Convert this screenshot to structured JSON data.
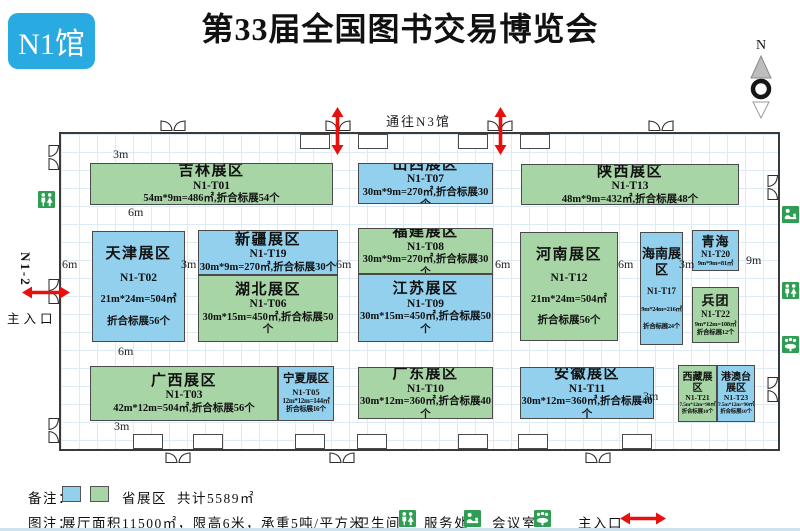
{
  "header": {
    "hall_badge": "N1馆",
    "title": "第33届全国图书交易博览会",
    "compass_north": "N"
  },
  "plan": {
    "corridor_label": "通往N3馆",
    "left_entrance_code": "N1-2",
    "left_entrance_label": "主入口",
    "dims": [
      "3m",
      "6m",
      "6m",
      "3m",
      "6m",
      "6m",
      "6m",
      "3m",
      "9m",
      "6m",
      "3m",
      "3m"
    ],
    "zones": [
      {
        "id": "jilin",
        "name": "吉林展区",
        "code": "N1-T01",
        "line3": "54m*9m=486㎡,折合标展54个",
        "line4": "",
        "color": "green"
      },
      {
        "id": "shanxi",
        "name": "山西展区",
        "code": "N1-T07",
        "line3": "30m*9m=270㎡,折合标展30个",
        "line4": "",
        "color": "blue"
      },
      {
        "id": "shaanxi",
        "name": "陕西展区",
        "code": "N1-T13",
        "line3": "48m*9m=432㎡,折合标展48个",
        "line4": "",
        "color": "green"
      },
      {
        "id": "tianjin",
        "name": "天津展区",
        "code": "N1-T02",
        "line3": "21m*24m=504㎡",
        "line4": "折合标展56个",
        "color": "blue"
      },
      {
        "id": "xinjiang",
        "name": "新疆展区",
        "code": "N1-T19",
        "line3": "30m*9m=270㎡,折合标展30个",
        "line4": "",
        "color": "blue"
      },
      {
        "id": "hubei",
        "name": "湖北展区",
        "code": "N1-T06",
        "line3": "30m*15m=450㎡,折合标展50个",
        "line4": "",
        "color": "green"
      },
      {
        "id": "fujian",
        "name": "福建展区",
        "code": "N1-T08",
        "line3": "30m*9m=270㎡,折合标展30个",
        "line4": "",
        "color": "green"
      },
      {
        "id": "jiangsu",
        "name": "江苏展区",
        "code": "N1-T09",
        "line3": "30m*15m=450㎡,折合标展50个",
        "line4": "",
        "color": "blue"
      },
      {
        "id": "henan",
        "name": "河南展区",
        "code": "N1-T12",
        "line3": "21m*24m=504㎡",
        "line4": "折合标展56个",
        "color": "green"
      },
      {
        "id": "hainan",
        "name": "海南展区",
        "code": "N1-T17",
        "line3": "9m*24m=216㎡",
        "line4": "折合标展24个",
        "color": "blue"
      },
      {
        "id": "qinghai",
        "name": "青海",
        "code": "N1-T20",
        "line3": "9m*9m=81㎡",
        "line4": "",
        "color": "blue"
      },
      {
        "id": "bingtuan",
        "name": "兵团",
        "code": "N1-T22",
        "line3": "9m*12m=108㎡",
        "line4": "折合标展12个",
        "color": "green"
      },
      {
        "id": "guangxi",
        "name": "广西展区",
        "code": "N1-T03",
        "line3": "42m*12m=504㎡,折合标展56个",
        "line4": "",
        "color": "green"
      },
      {
        "id": "ningxia",
        "name": "宁夏展区",
        "code": "N1-T05",
        "line3": "12m*12m=144㎡",
        "line4": "折合标展16个",
        "color": "blue"
      },
      {
        "id": "guangdong",
        "name": "广东展区",
        "code": "N1-T10",
        "line3": "30m*12m=360㎡,折合标展40个",
        "line4": "",
        "color": "green"
      },
      {
        "id": "anhui",
        "name": "安徽展区",
        "code": "N1-T11",
        "line3": "30m*12m=360㎡,折合标展40个",
        "line4": "",
        "color": "blue"
      },
      {
        "id": "xizang",
        "name": "西藏展区",
        "code": "N1-T21",
        "line3": "7.5m*12m=90㎡",
        "line4": "折合标展10个",
        "color": "green"
      },
      {
        "id": "gangaotai",
        "name": "港澳台展区",
        "code": "N1-T23",
        "line3": "7.5m*12m=90㎡",
        "line4": "折合标展10个",
        "color": "blue"
      }
    ]
  },
  "legend": {
    "note_label": "备注：",
    "province_zone_label": "省展区",
    "total_area": "共计5589㎡",
    "caption_label": "图注：",
    "hall_specs": "展厅面积11500㎡，限高6米，承重5吨/平方米",
    "toilet_label": "卫生间",
    "service_label": "服务处",
    "meeting_label": "会议室",
    "entrance_label": "主入口"
  },
  "colors": {
    "province_blue": "#92d0ee",
    "province_green": "#a8d5a6",
    "accent_red": "#e8100c",
    "badge_blue": "#29aae1",
    "icon_green": "#2f9e53"
  }
}
